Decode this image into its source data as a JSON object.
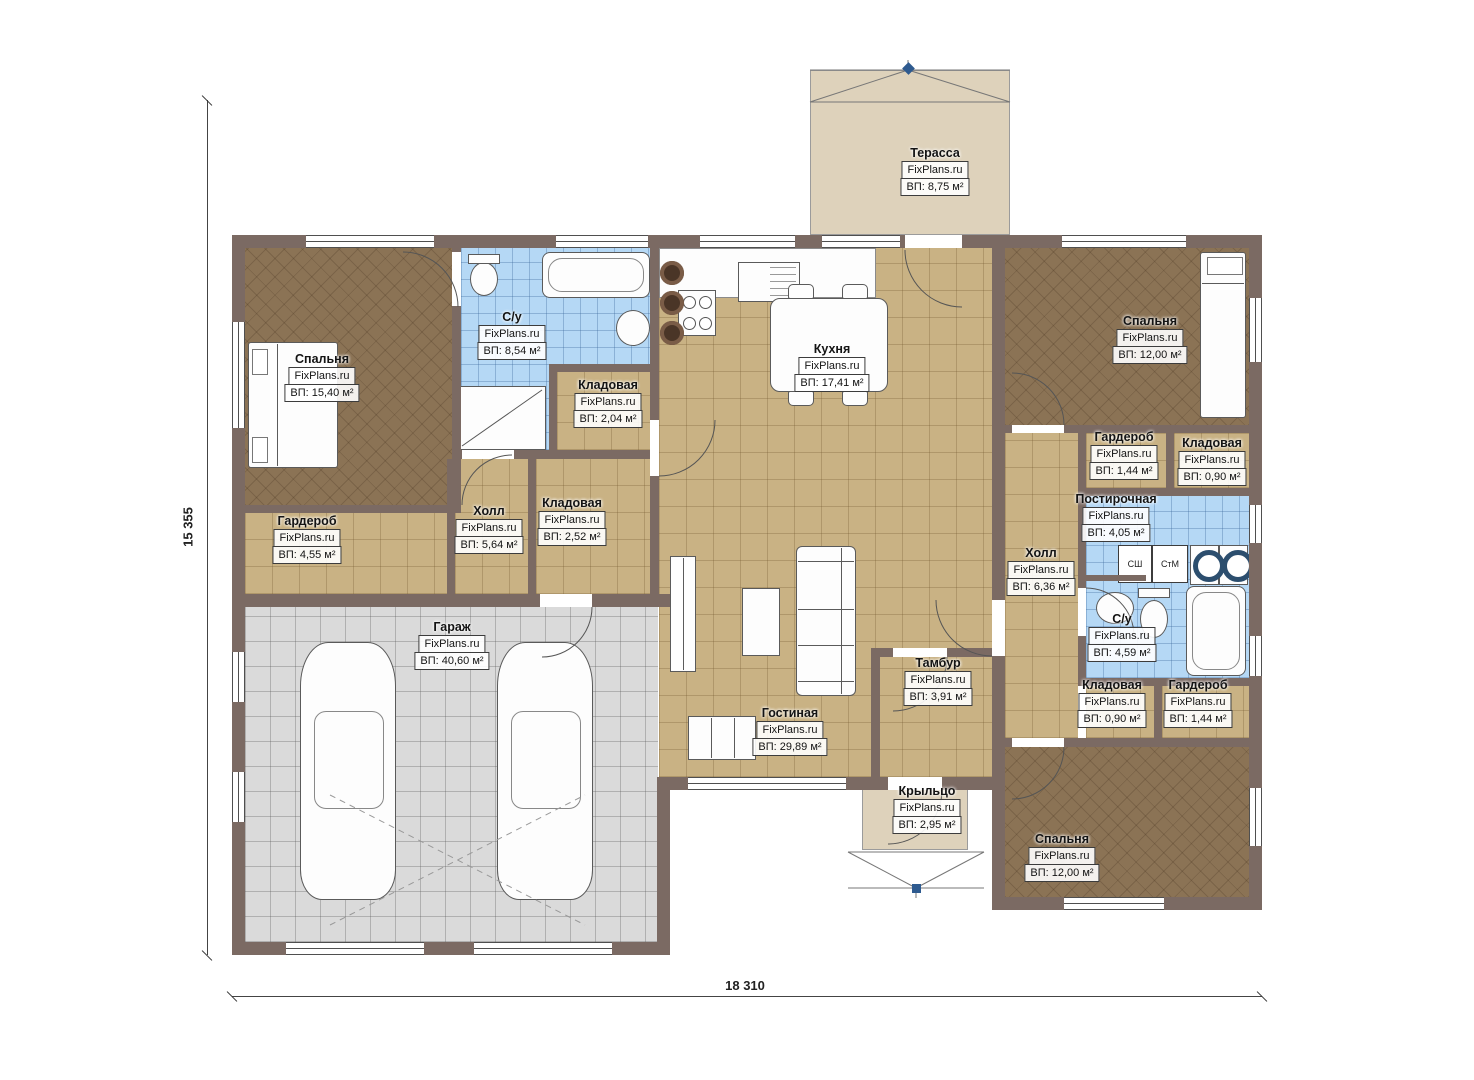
{
  "plan": {
    "brand": "FixPlans.ru",
    "dim_bottom": "18 310",
    "dim_left": "15 355"
  },
  "appliances": {
    "dryer": "СШ",
    "washer": "СтМ"
  },
  "rooms": {
    "terrace": {
      "name": "Терасса",
      "area": "ВП: 8,75 м²"
    },
    "bedroom_left": {
      "name": "Спальня",
      "area": "ВП: 15,40 м²"
    },
    "bath_left": {
      "name": "С/у",
      "area": "ВП: 8,54 м²"
    },
    "storage_top": {
      "name": "Кладовая",
      "area": "ВП: 2,04 м²"
    },
    "kitchen": {
      "name": "Кухня",
      "area": "ВП: 17,41 м²"
    },
    "bedroom_tr": {
      "name": "Спальня",
      "area": "ВП: 12,00 м²"
    },
    "wardrobe_ru": {
      "name": "Гардероб",
      "area": "ВП: 1,44 м²"
    },
    "storage_ru": {
      "name": "Кладовая",
      "area": "ВП: 0,90 м²"
    },
    "laundry": {
      "name": "Постирочная",
      "area": "ВП: 4,05 м²"
    },
    "hall_right": {
      "name": "Холл",
      "area": "ВП: 6,36 м²"
    },
    "bath_right": {
      "name": "С/у",
      "area": "ВП: 4,59 м²"
    },
    "storage_rl": {
      "name": "Кладовая",
      "area": "ВП: 0,90 м²"
    },
    "wardrobe_rl": {
      "name": "Гардероб",
      "area": "ВП: 1,44 м²"
    },
    "bedroom_br": {
      "name": "Спальня",
      "area": "ВП: 12,00 м²"
    },
    "wardrobe_left": {
      "name": "Гардероб",
      "area": "ВП: 4,55 м²"
    },
    "hall_left": {
      "name": "Холл",
      "area": "ВП: 5,64 м²"
    },
    "storage_mid": {
      "name": "Кладовая",
      "area": "ВП: 2,52 м²"
    },
    "garage": {
      "name": "Гараж",
      "area": "ВП: 40,60 м²"
    },
    "living": {
      "name": "Гостиная",
      "area": "ВП: 29,89 м²"
    },
    "vestibule": {
      "name": "Тамбур",
      "area": "ВП: 3,91 м²"
    },
    "porch": {
      "name": "Крыльцо",
      "area": "ВП: 2,95 м²"
    }
  },
  "colors": {
    "wall": "#7b6a63",
    "wood_floor": "#8b7355",
    "tile_tan": "#c9b284",
    "tile_blue": "#b5d8f5",
    "tile_gray": "#dadada",
    "deck": "#ded2bb",
    "roof_marker": "#2e5a8f"
  }
}
